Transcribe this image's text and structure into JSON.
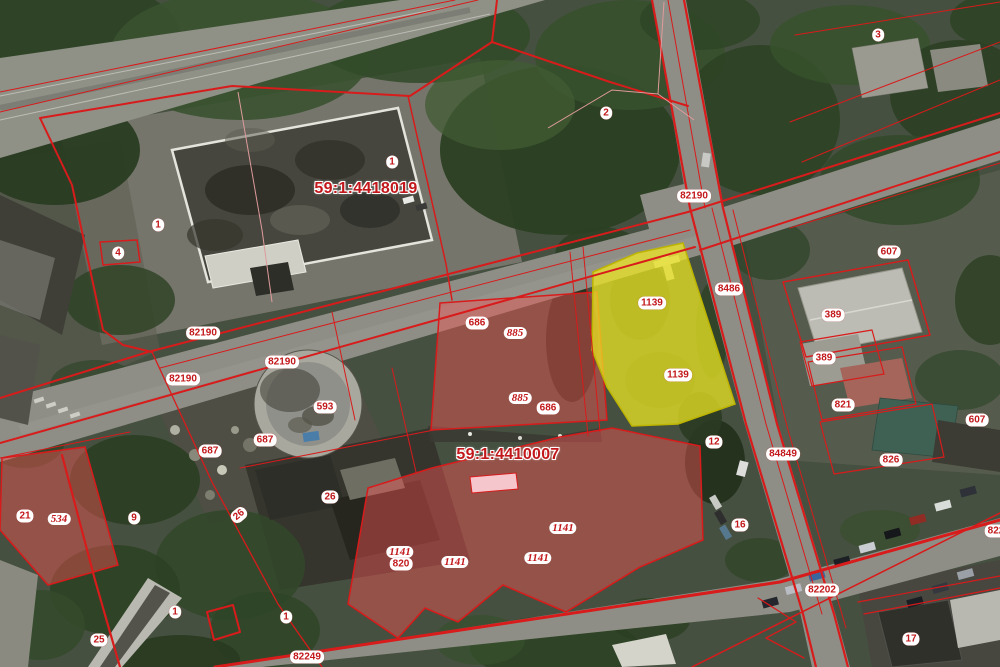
{
  "map": {
    "selected_parcel_label": "1139",
    "colors": {
      "boundary_red": "#d81b1b",
      "label_red": "#c2181b",
      "label_bg": "#ffffff",
      "parcel_pink_fill": "rgba(244,84,84,0.45)",
      "selected_yellow_fill": "rgba(236,230,35,0.75)",
      "selected_yellow_stroke": "#bdb400",
      "road_gray": "#8e8e86",
      "veg_green": "#3a4f2e"
    },
    "labels": [
      {
        "text": "3",
        "x": 878,
        "y": 35,
        "kind": "pill"
      },
      {
        "text": "2",
        "x": 606,
        "y": 113,
        "kind": "pill"
      },
      {
        "text": "1",
        "x": 392,
        "y": 162,
        "kind": "pill"
      },
      {
        "text": "59:1:4418019",
        "x": 366,
        "y": 189,
        "kind": "qtr"
      },
      {
        "text": "82190",
        "x": 694,
        "y": 196,
        "kind": "pill"
      },
      {
        "text": "1",
        "x": 158,
        "y": 225,
        "kind": "pill"
      },
      {
        "text": "607",
        "x": 889,
        "y": 252,
        "kind": "pill"
      },
      {
        "text": "4",
        "x": 118,
        "y": 253,
        "kind": "pill"
      },
      {
        "text": "8486",
        "x": 729,
        "y": 289,
        "kind": "pill"
      },
      {
        "text": "1139",
        "x": 652,
        "y": 303,
        "kind": "pill"
      },
      {
        "text": "389",
        "x": 833,
        "y": 315,
        "kind": "pill"
      },
      {
        "text": "686",
        "x": 477,
        "y": 323,
        "kind": "pill"
      },
      {
        "text": "885",
        "x": 515,
        "y": 333,
        "kind": "bld"
      },
      {
        "text": "82190",
        "x": 203,
        "y": 333,
        "kind": "pill"
      },
      {
        "text": "389",
        "x": 824,
        "y": 358,
        "kind": "pill"
      },
      {
        "text": "82190",
        "x": 282,
        "y": 362,
        "kind": "pill"
      },
      {
        "text": "1139",
        "x": 678,
        "y": 375,
        "kind": "pill"
      },
      {
        "text": "82190",
        "x": 183,
        "y": 379,
        "kind": "pill"
      },
      {
        "text": "885",
        "x": 520,
        "y": 398,
        "kind": "bld"
      },
      {
        "text": "821",
        "x": 843,
        "y": 405,
        "kind": "pill"
      },
      {
        "text": "593",
        "x": 325,
        "y": 407,
        "kind": "pill"
      },
      {
        "text": "686",
        "x": 548,
        "y": 408,
        "kind": "pill"
      },
      {
        "text": "607",
        "x": 977,
        "y": 420,
        "kind": "pill"
      },
      {
        "text": "687",
        "x": 265,
        "y": 440,
        "kind": "pill"
      },
      {
        "text": "12",
        "x": 714,
        "y": 442,
        "kind": "pill"
      },
      {
        "text": "687",
        "x": 210,
        "y": 451,
        "kind": "pill"
      },
      {
        "text": "84849",
        "x": 783,
        "y": 454,
        "kind": "pill"
      },
      {
        "text": "59:1:4410007",
        "x": 508,
        "y": 455,
        "kind": "qtr"
      },
      {
        "text": "826",
        "x": 891,
        "y": 460,
        "kind": "pill"
      },
      {
        "text": "26",
        "x": 330,
        "y": 497,
        "kind": "pill"
      },
      {
        "text": "26",
        "x": 239,
        "y": 515,
        "kind": "pill",
        "rot": -40
      },
      {
        "text": "21",
        "x": 25,
        "y": 516,
        "kind": "pill"
      },
      {
        "text": "534",
        "x": 59,
        "y": 519,
        "kind": "bld"
      },
      {
        "text": "9",
        "x": 134,
        "y": 518,
        "kind": "pill"
      },
      {
        "text": "16",
        "x": 740,
        "y": 525,
        "kind": "pill"
      },
      {
        "text": "1141",
        "x": 563,
        "y": 528,
        "kind": "bld"
      },
      {
        "text": "822",
        "x": 996,
        "y": 531,
        "kind": "pill"
      },
      {
        "text": "1141",
        "x": 400,
        "y": 552,
        "kind": "bld"
      },
      {
        "text": "1141",
        "x": 455,
        "y": 562,
        "kind": "bld"
      },
      {
        "text": "1141",
        "x": 538,
        "y": 558,
        "kind": "bld"
      },
      {
        "text": "820",
        "x": 401,
        "y": 564,
        "kind": "pill"
      },
      {
        "text": "82202",
        "x": 822,
        "y": 590,
        "kind": "pill"
      },
      {
        "text": "1",
        "x": 175,
        "y": 612,
        "kind": "pill"
      },
      {
        "text": "1",
        "x": 286,
        "y": 617,
        "kind": "pill"
      },
      {
        "text": "17",
        "x": 911,
        "y": 639,
        "kind": "pill"
      },
      {
        "text": "25",
        "x": 99,
        "y": 640,
        "kind": "pill"
      },
      {
        "text": "82249",
        "x": 307,
        "y": 657,
        "kind": "pill"
      }
    ]
  }
}
